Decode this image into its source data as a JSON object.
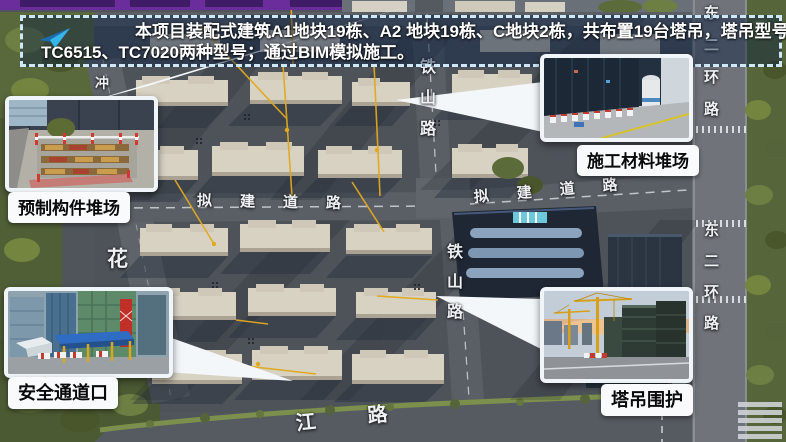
{
  "slide": {
    "top_bar_color": "#6b2d9b",
    "banner_border_color": "#cfe8f8"
  },
  "banner": {
    "icon": "paper-plane-icon",
    "line1": "本项目装配式建筑A1地块19栋、A2 地块19栋、C地块2栋，共布置19台塔吊，塔吊型号主要使用",
    "line2": "TC6515、TC7020两种型号；通过BIM模拟施工。"
  },
  "callouts": {
    "precast_yard": {
      "label": "预制构件堆场"
    },
    "material_yard": {
      "label": "施工材料堆场"
    },
    "safety_passage": {
      "label": "安全通道口"
    },
    "crane_enclosure": {
      "label": "塔吊围护"
    }
  },
  "road_labels": {
    "tieshan_road_upper": "铁山路",
    "tieshan_road_lower": "铁山路",
    "proposed_road_west": "拟建道路",
    "proposed_road_east": "拟建道路",
    "east_ring_road_upper": "东二环路",
    "east_ring_road_lower": "东二环路",
    "hua_road": "花",
    "chong_road": "冲",
    "river_road": "江路"
  },
  "colors": {
    "callout_pointer": "#f3f7fa",
    "crane_radius_line": "#e2a81e",
    "road_surface": "#5a5f66",
    "building_block": "#d8d2c3",
    "tree_green": "#5c6c34",
    "label_background": "#f8fafc"
  }
}
